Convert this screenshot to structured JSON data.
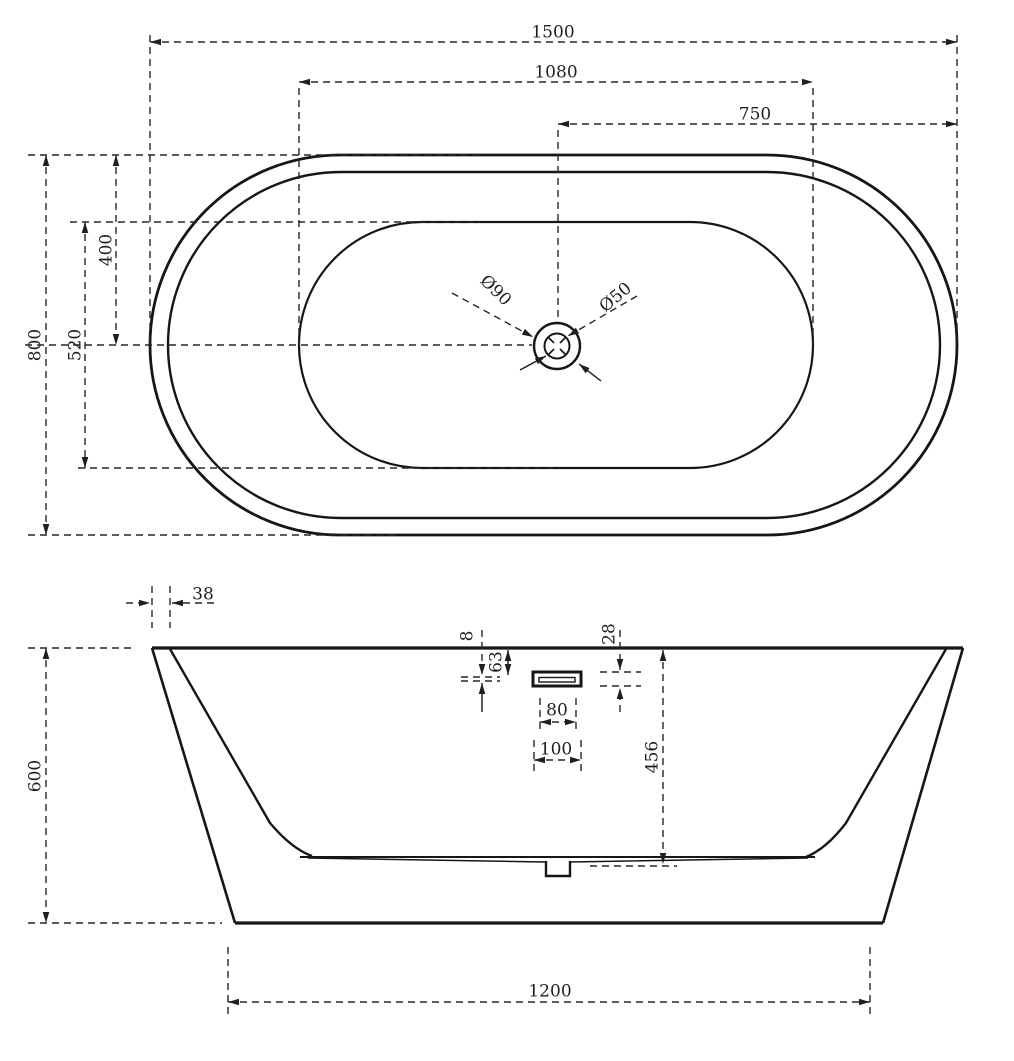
{
  "drawing": {
    "type": "bathtub-technical-drawing",
    "views": {
      "top_view": "plan view of oval freestanding bathtub with drain",
      "front_view": "front elevation of bathtub with overflow detail"
    },
    "colors": {
      "line": "#161616",
      "dimension": "#262626",
      "background": "#ffffff"
    },
    "labels": {
      "overall_length": "1500",
      "basin_length": "1080",
      "drain_offset": "750",
      "overall_width": "800",
      "basin_width": "520",
      "half_width": "400",
      "drain_outer_dia": "Ø90",
      "drain_inner_dia": "Ø50",
      "rim_thickness": "38",
      "height": "600",
      "overflow_slot_height": "8",
      "overflow_center_depth": "63",
      "overflow_outer_height": "28",
      "overflow_slot_width": "80",
      "overflow_outer_width": "100",
      "inner_depth": "456",
      "base_length": "1200"
    }
  }
}
